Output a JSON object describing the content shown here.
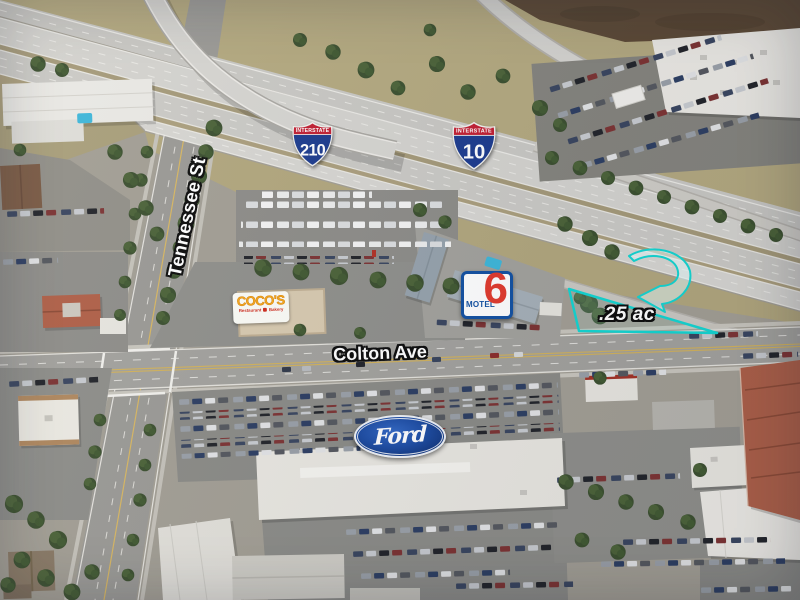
{
  "map_annotations": {
    "street_labels": {
      "tennessee": "Tennessee St",
      "colton": "Colton Ave"
    },
    "highway_shields": {
      "banner": "INTERSTATE",
      "route_210": "210",
      "route_10": "10"
    },
    "parcel": {
      "label": ".25 ac",
      "outline_color": "#14d6d2"
    },
    "businesses": {
      "cocos": {
        "name": "COCO'S",
        "tagline_left": "Restaurant",
        "tagline_right": "Bakery"
      },
      "motel6": {
        "word": "MOTEL",
        "numeral": "6"
      },
      "ford": {
        "wordmark": "Ford"
      }
    },
    "colors": {
      "annotation_teal": "#14d6d2",
      "interstate_blue": "#1d3c8f",
      "interstate_red": "#c22033",
      "ford_blue": "#1e4da4",
      "motel_blue": "#1452a3",
      "motel_red": "#e23b2e",
      "cocos_orange": "#f9a91a",
      "cocos_red": "#cf2b1d"
    }
  }
}
